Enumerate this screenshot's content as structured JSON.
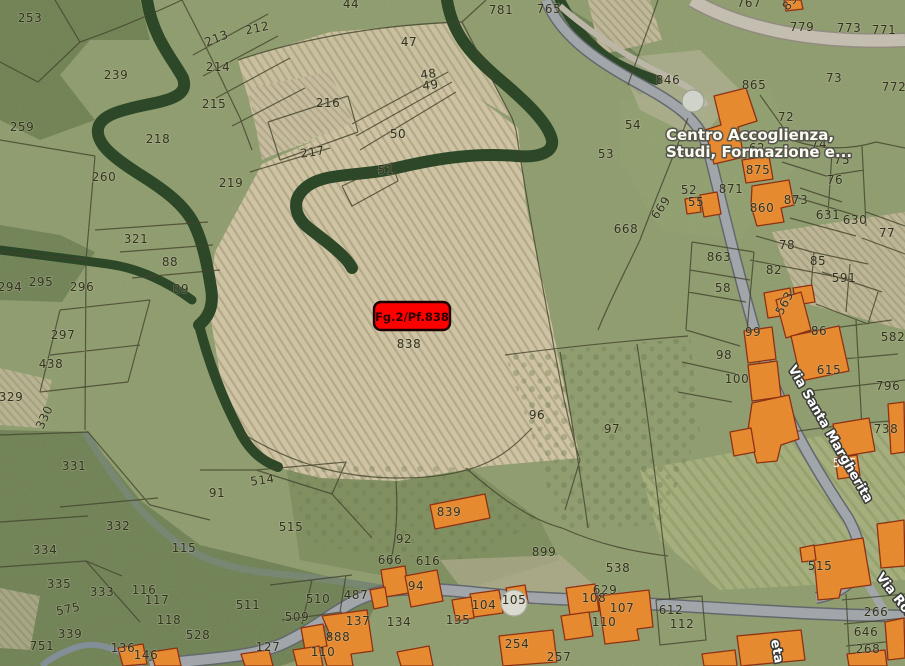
{
  "map": {
    "highlight_marker": {
      "label": "Fg.2/Pf.838",
      "fill": "#ff0000",
      "border_color": "#1a0000",
      "text_color": "#2b0000"
    },
    "poi": {
      "line1": "Centro Accoglienza,",
      "line2": "Studi, Formazione e..."
    },
    "streets": [
      {
        "name": "Via Santa Margherita",
        "x": 827,
        "y": 436,
        "r": 60
      },
      {
        "name": "Via Ron",
        "x": 893,
        "y": 599,
        "r": 52
      },
      {
        "name": "eta",
        "x": 773,
        "y": 652,
        "r": 80
      }
    ],
    "colors": {
      "terrain_base": "#8c9a6d",
      "vineyard": "#cdc2a2",
      "woods": "#5c6f47",
      "road": "#9ea3a8",
      "building_fill": "#e6862f",
      "building_stroke": "#8a2f12",
      "boundary": "#41412c",
      "parcel_label": "#32321f",
      "street_label": "#ffffff",
      "highlight": "#ff0000"
    },
    "parcel_labels": [
      {
        "t": "253",
        "x": 30,
        "y": 22
      },
      {
        "t": "213",
        "x": 218,
        "y": 42,
        "r": -22
      },
      {
        "t": "212",
        "x": 258,
        "y": 32,
        "r": -12
      },
      {
        "t": "214",
        "x": 218,
        "y": 71
      },
      {
        "t": "239",
        "x": 116,
        "y": 79
      },
      {
        "t": "215",
        "x": 214,
        "y": 108
      },
      {
        "t": "259",
        "x": 22,
        "y": 131
      },
      {
        "t": "218",
        "x": 158,
        "y": 143
      },
      {
        "t": "260",
        "x": 104,
        "y": 181
      },
      {
        "t": "219",
        "x": 231,
        "y": 187
      },
      {
        "t": "321",
        "x": 136,
        "y": 243
      },
      {
        "t": "88",
        "x": 170,
        "y": 266
      },
      {
        "t": "89",
        "x": 181,
        "y": 293
      },
      {
        "t": "294",
        "x": 10,
        "y": 291
      },
      {
        "t": "295",
        "x": 41,
        "y": 286
      },
      {
        "t": "296",
        "x": 82,
        "y": 291
      },
      {
        "t": "297",
        "x": 63,
        "y": 339
      },
      {
        "t": "438",
        "x": 51,
        "y": 368
      },
      {
        "t": "329",
        "x": 11,
        "y": 401
      },
      {
        "t": "330",
        "x": 48,
        "y": 419,
        "r": -65
      },
      {
        "t": "331",
        "x": 74,
        "y": 470
      },
      {
        "t": "332",
        "x": 118,
        "y": 530
      },
      {
        "t": "334",
        "x": 45,
        "y": 554
      },
      {
        "t": "335",
        "x": 59,
        "y": 588
      },
      {
        "t": "333",
        "x": 102,
        "y": 596
      },
      {
        "t": "575",
        "x": 69,
        "y": 613,
        "r": -12
      },
      {
        "t": "339",
        "x": 70,
        "y": 638
      },
      {
        "t": "751",
        "x": 42,
        "y": 650
      },
      {
        "t": "136",
        "x": 123,
        "y": 652
      },
      {
        "t": "146",
        "x": 146,
        "y": 659
      },
      {
        "t": "116",
        "x": 144,
        "y": 594
      },
      {
        "t": "117",
        "x": 157,
        "y": 604
      },
      {
        "t": "118",
        "x": 169,
        "y": 624
      },
      {
        "t": "528",
        "x": 198,
        "y": 639
      },
      {
        "t": "115",
        "x": 184,
        "y": 552
      },
      {
        "t": "91",
        "x": 217,
        "y": 497
      },
      {
        "t": "514",
        "x": 263,
        "y": 484,
        "r": -8
      },
      {
        "t": "515",
        "x": 291,
        "y": 531
      },
      {
        "t": "511",
        "x": 248,
        "y": 609
      },
      {
        "t": "510",
        "x": 318,
        "y": 603
      },
      {
        "t": "509",
        "x": 297,
        "y": 621
      },
      {
        "t": "487",
        "x": 356,
        "y": 599
      },
      {
        "t": "127",
        "x": 268,
        "y": 651
      },
      {
        "t": "888",
        "x": 338,
        "y": 641
      },
      {
        "t": "137",
        "x": 358,
        "y": 625
      },
      {
        "t": "110",
        "x": 323,
        "y": 656
      },
      {
        "t": "134",
        "x": 399,
        "y": 626
      },
      {
        "t": "135",
        "x": 458,
        "y": 624
      },
      {
        "t": "44",
        "x": 351,
        "y": 8
      },
      {
        "t": "47",
        "x": 409,
        "y": 46
      },
      {
        "t": "48",
        "x": 429,
        "y": 78,
        "r": -8
      },
      {
        "t": "49",
        "x": 431,
        "y": 89,
        "r": -8
      },
      {
        "t": "216",
        "x": 328,
        "y": 107
      },
      {
        "t": "50",
        "x": 398,
        "y": 138
      },
      {
        "t": "217",
        "x": 313,
        "y": 156,
        "r": -8
      },
      {
        "t": "51",
        "x": 386,
        "y": 174
      },
      {
        "t": "781",
        "x": 501,
        "y": 14
      },
      {
        "t": "765",
        "x": 549,
        "y": 13
      },
      {
        "t": "668",
        "x": 626,
        "y": 233
      },
      {
        "t": "838",
        "x": 409,
        "y": 348
      },
      {
        "t": "96",
        "x": 537,
        "y": 419
      },
      {
        "t": "97",
        "x": 612,
        "y": 433
      },
      {
        "t": "899",
        "x": 544,
        "y": 556
      },
      {
        "t": "538",
        "x": 618,
        "y": 572
      },
      {
        "t": "92",
        "x": 404,
        "y": 543
      },
      {
        "t": "839",
        "x": 449,
        "y": 516
      },
      {
        "t": "666",
        "x": 390,
        "y": 564
      },
      {
        "t": "616",
        "x": 428,
        "y": 565
      },
      {
        "t": "94",
        "x": 416,
        "y": 590
      },
      {
        "t": "104",
        "x": 484,
        "y": 609
      },
      {
        "t": "105",
        "x": 514,
        "y": 604
      },
      {
        "t": "254",
        "x": 517,
        "y": 648
      },
      {
        "t": "257",
        "x": 559,
        "y": 661
      },
      {
        "t": "767",
        "x": 749,
        "y": 7
      },
      {
        "t": "85",
        "x": 793,
        "y": 5,
        "r": -50
      },
      {
        "t": "779",
        "x": 802,
        "y": 31
      },
      {
        "t": "773",
        "x": 849,
        "y": 32
      },
      {
        "t": "771",
        "x": 884,
        "y": 34
      },
      {
        "t": "846",
        "x": 668,
        "y": 84
      },
      {
        "t": "865",
        "x": 754,
        "y": 89
      },
      {
        "t": "73",
        "x": 834,
        "y": 82
      },
      {
        "t": "54",
        "x": 633,
        "y": 129
      },
      {
        "t": "53",
        "x": 606,
        "y": 158
      },
      {
        "t": "72",
        "x": 786,
        "y": 121
      },
      {
        "t": "772",
        "x": 894,
        "y": 91
      },
      {
        "t": "74",
        "x": 819,
        "y": 148
      },
      {
        "t": "75",
        "x": 842,
        "y": 164
      },
      {
        "t": "76",
        "x": 835,
        "y": 184
      },
      {
        "t": "52",
        "x": 689,
        "y": 194
      },
      {
        "t": "669",
        "x": 664,
        "y": 210,
        "r": -55
      },
      {
        "t": "873",
        "x": 796,
        "y": 204
      },
      {
        "t": "631",
        "x": 828,
        "y": 219
      },
      {
        "t": "630",
        "x": 855,
        "y": 224
      },
      {
        "t": "77",
        "x": 887,
        "y": 237
      },
      {
        "t": "863",
        "x": 719,
        "y": 261
      },
      {
        "t": "78",
        "x": 787,
        "y": 249
      },
      {
        "t": "85",
        "x": 818,
        "y": 265
      },
      {
        "t": "82",
        "x": 774,
        "y": 274
      },
      {
        "t": "591",
        "x": 844,
        "y": 282
      },
      {
        "t": "58",
        "x": 723,
        "y": 292
      },
      {
        "t": "98",
        "x": 724,
        "y": 359
      },
      {
        "t": "99",
        "x": 753,
        "y": 336
      },
      {
        "t": "100",
        "x": 737,
        "y": 383
      },
      {
        "t": "563",
        "x": 788,
        "y": 305,
        "r": -62
      },
      {
        "t": "86",
        "x": 819,
        "y": 335
      },
      {
        "t": "582",
        "x": 893,
        "y": 341
      },
      {
        "t": "615",
        "x": 829,
        "y": 374
      },
      {
        "t": "796",
        "x": 888,
        "y": 390
      },
      {
        "t": "738",
        "x": 886,
        "y": 433
      },
      {
        "t": "875",
        "x": 758,
        "y": 174
      },
      {
        "t": "871",
        "x": 731,
        "y": 193
      },
      {
        "t": "62",
        "x": 757,
        "y": 152
      },
      {
        "t": "860",
        "x": 762,
        "y": 212
      },
      {
        "t": "55",
        "x": 696,
        "y": 206
      },
      {
        "t": "515",
        "x": 820,
        "y": 570
      },
      {
        "t": "555",
        "x": 845,
        "y": 467,
        "c": "#f2f2e8"
      },
      {
        "t": "629",
        "x": 605,
        "y": 594
      },
      {
        "t": "108",
        "x": 594,
        "y": 602
      },
      {
        "t": "107",
        "x": 622,
        "y": 612
      },
      {
        "t": "110",
        "x": 604,
        "y": 626
      },
      {
        "t": "612",
        "x": 671,
        "y": 614
      },
      {
        "t": "112",
        "x": 682,
        "y": 628
      },
      {
        "t": "266",
        "x": 876,
        "y": 616
      },
      {
        "t": "646",
        "x": 866,
        "y": 636
      },
      {
        "t": "268",
        "x": 868,
        "y": 653
      }
    ]
  }
}
